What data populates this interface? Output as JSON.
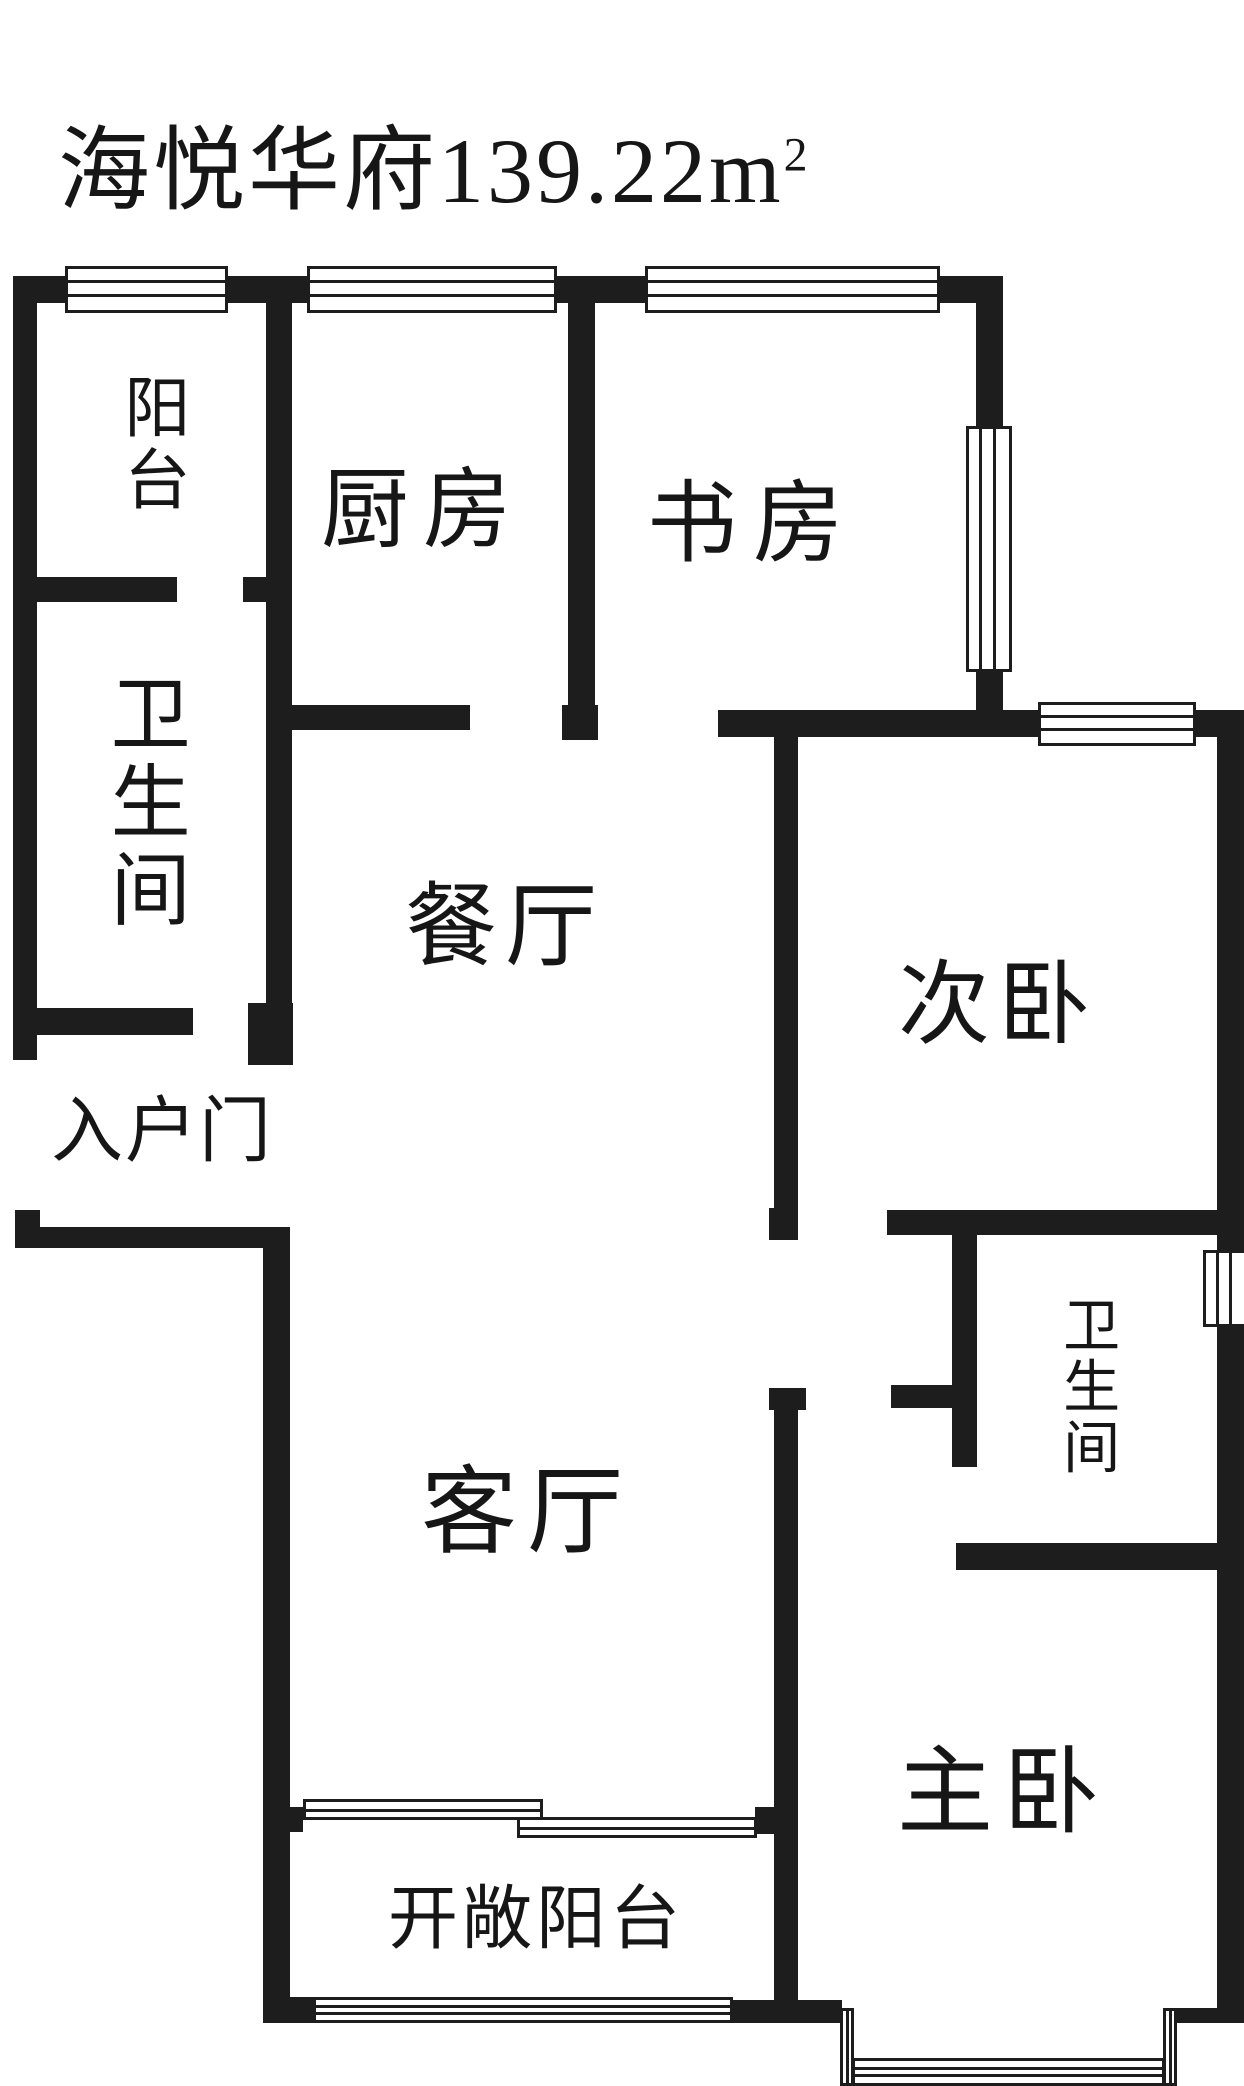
{
  "title": {
    "text": "海悦华府139.22",
    "unit": "m",
    "sup": "2"
  },
  "rooms": [
    {
      "id": "balcony-north",
      "label": "阳台",
      "orientation": "vertical"
    },
    {
      "id": "kitchen",
      "label": "厨房",
      "orientation": "horizontal"
    },
    {
      "id": "study",
      "label": "书房",
      "orientation": "horizontal"
    },
    {
      "id": "bathroom-north",
      "label": "卫生间",
      "orientation": "vertical"
    },
    {
      "id": "dining",
      "label": "餐厅",
      "orientation": "horizontal"
    },
    {
      "id": "bedroom-second",
      "label": "次卧",
      "orientation": "horizontal"
    },
    {
      "id": "entry-door",
      "label": "入户门",
      "orientation": "horizontal"
    },
    {
      "id": "bathroom-south",
      "label": "卫生间",
      "orientation": "vertical"
    },
    {
      "id": "living",
      "label": "客厅",
      "orientation": "horizontal"
    },
    {
      "id": "bedroom-master",
      "label": "主卧",
      "orientation": "horizontal"
    },
    {
      "id": "balcony-south",
      "label": "开敞阳台",
      "orientation": "horizontal"
    }
  ],
  "colors": {
    "wall": "#1d1d1d",
    "background": "#ffffff",
    "text": "#161616"
  }
}
